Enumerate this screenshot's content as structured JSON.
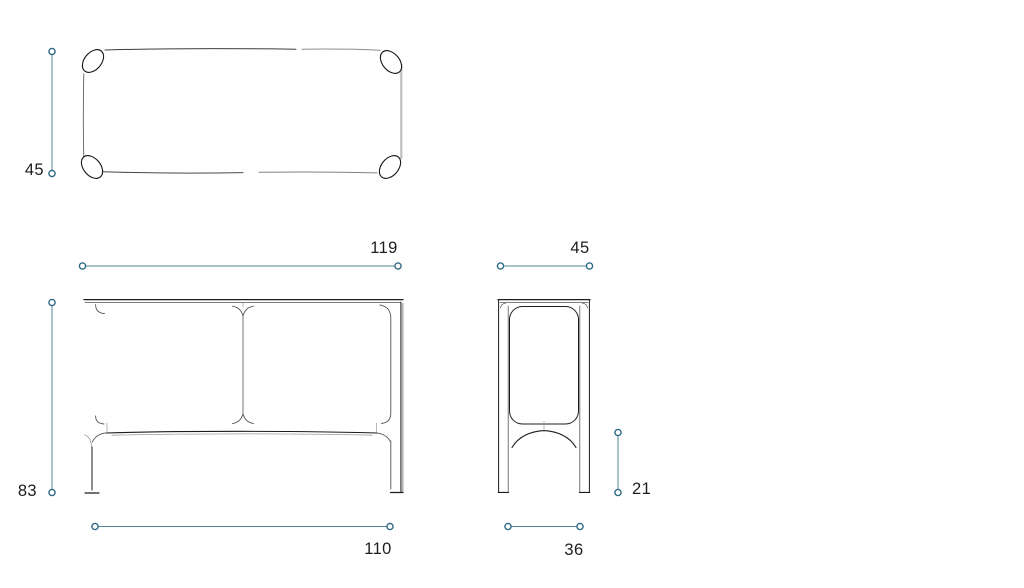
{
  "drawing": {
    "kind": "furniture dimension drawing",
    "views": {
      "top": {
        "name": "top view"
      },
      "front": {
        "name": "front view"
      },
      "side": {
        "name": "side view"
      }
    }
  },
  "dimensions": {
    "top_depth": "45",
    "front_width": "119",
    "front_height": "83",
    "front_foot_span": "110",
    "side_depth": "45",
    "side_stretcher_height": "21",
    "side_foot_span": "36"
  },
  "colors": {
    "dimension_line": "#54849a",
    "dimension_marker": "#2c6783",
    "text": "#1d1d1f",
    "drawing_line": "#1c1c1c",
    "background": "#ffffff"
  }
}
